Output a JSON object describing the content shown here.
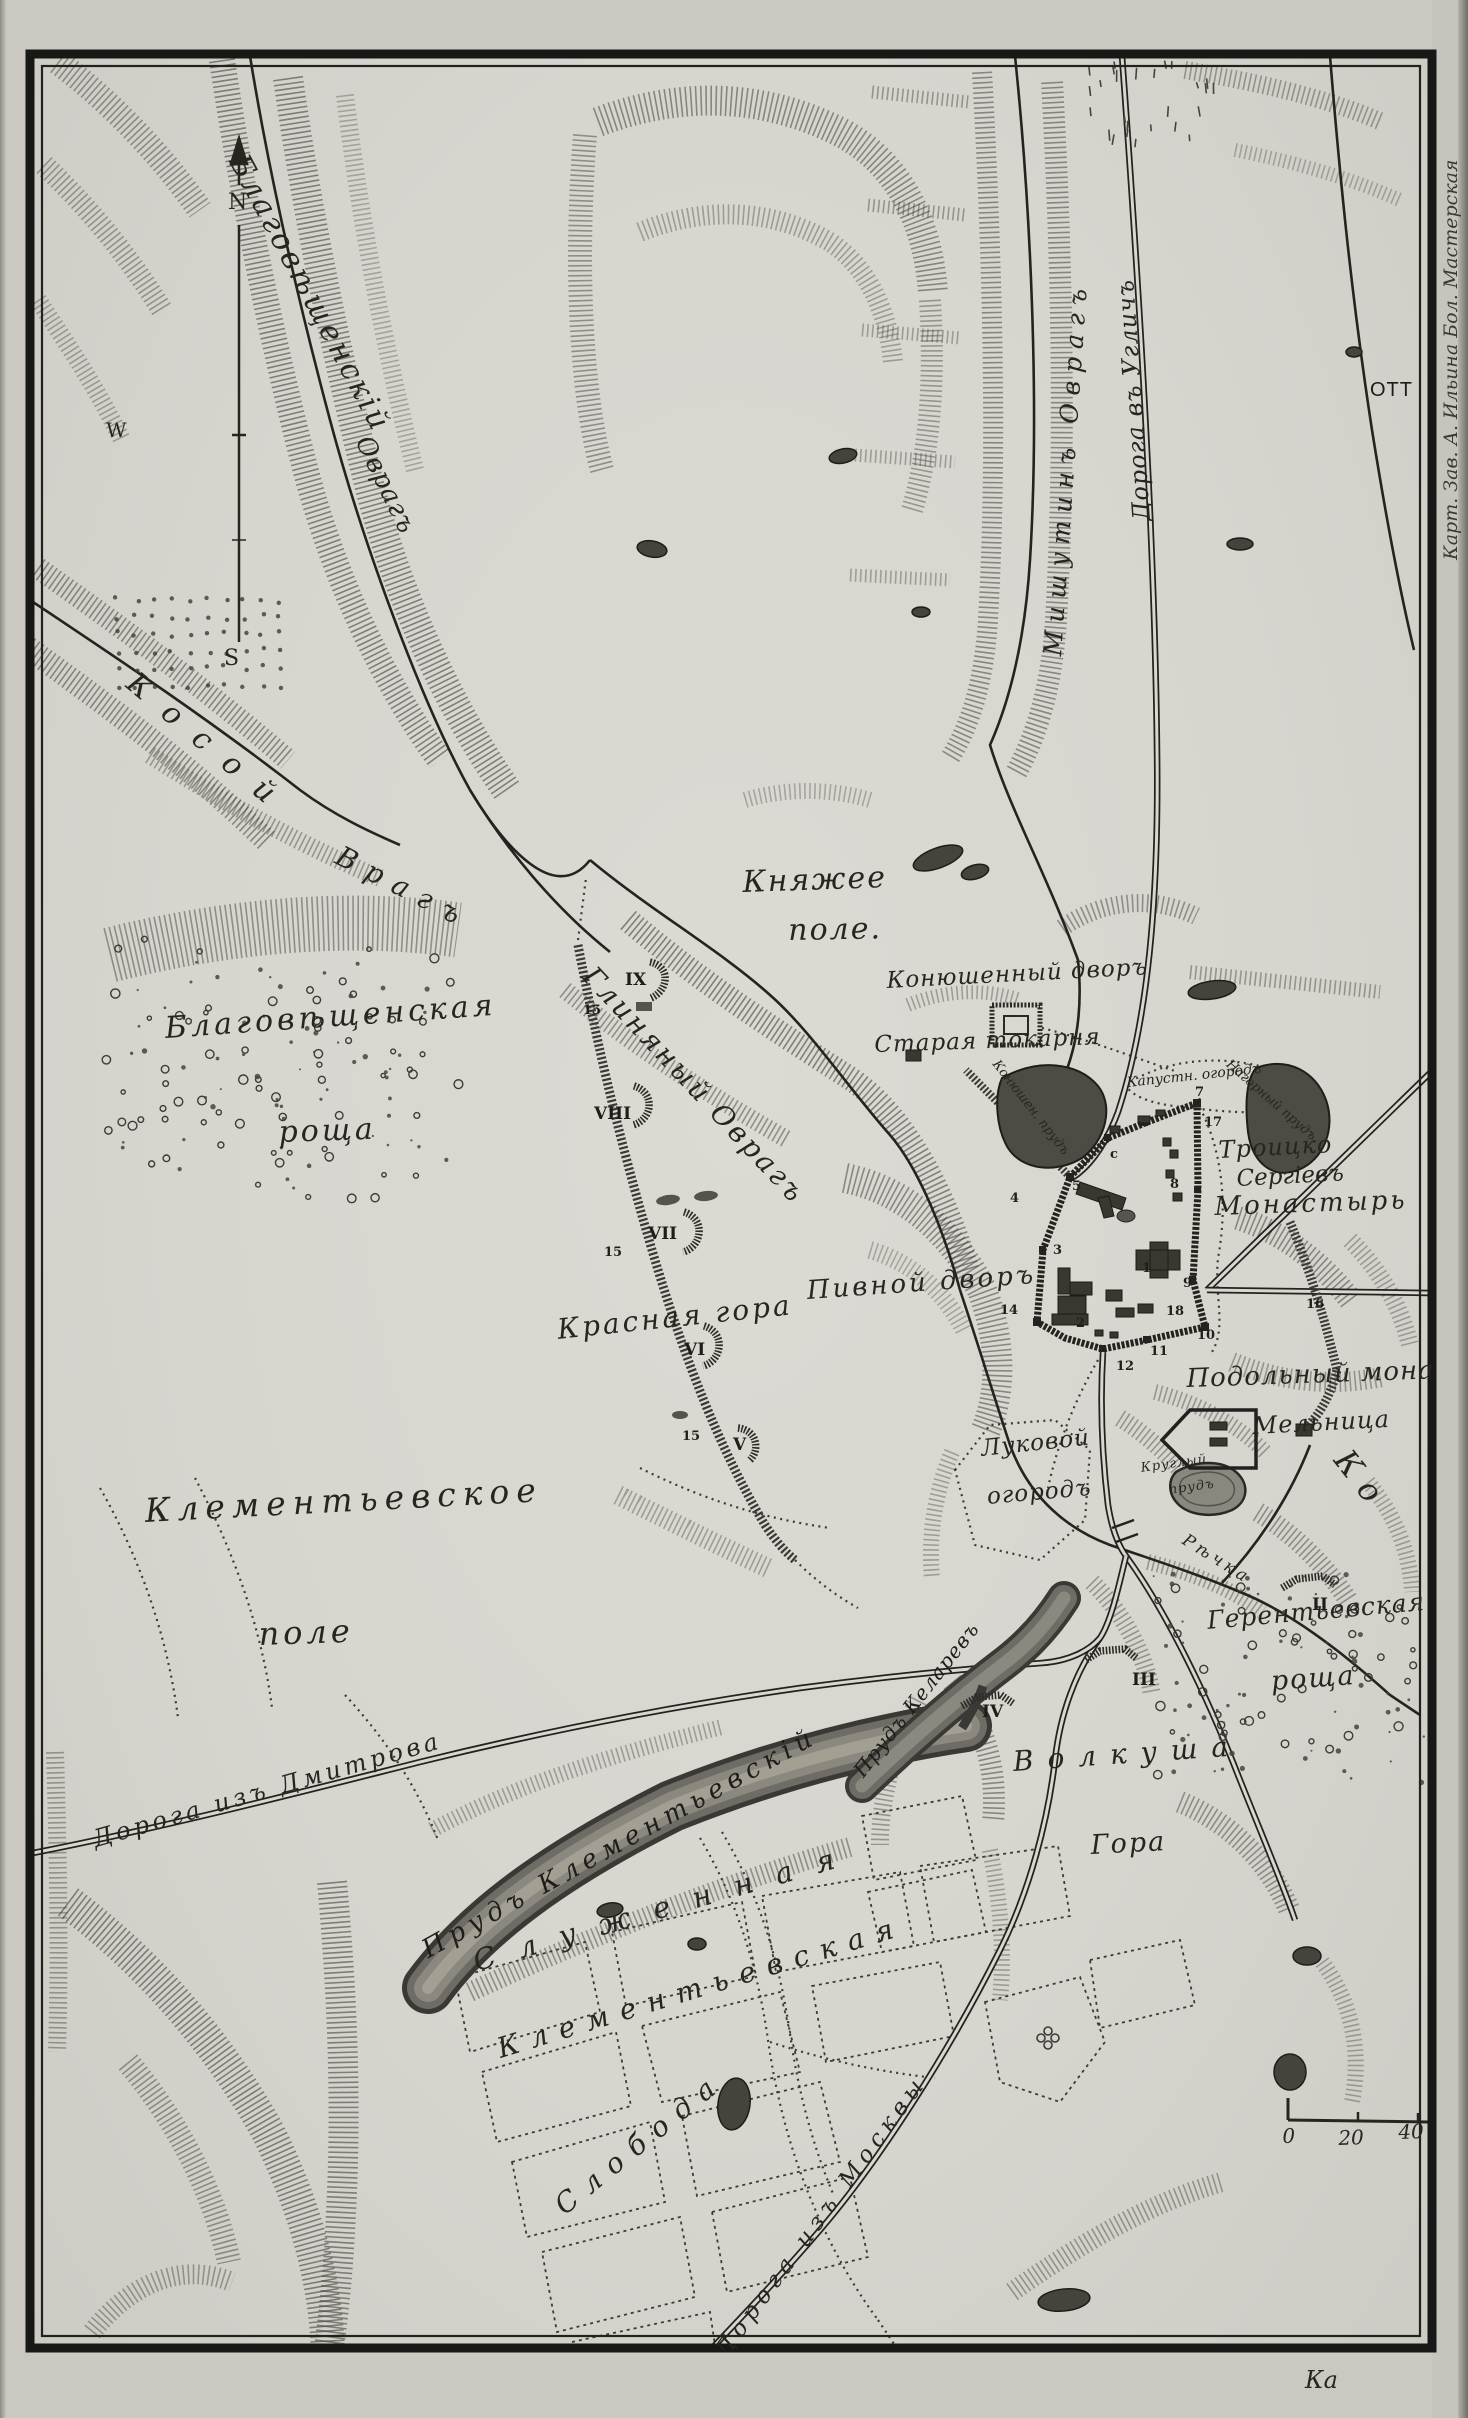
{
  "map": {
    "compass": {
      "n": "N",
      "w": "W",
      "s": "S"
    },
    "imprint": "Карт. Зав. А. Ильина Бол. Мастерская",
    "edge_fragment_right": "ОТТ",
    "edge_fragment_bottom": "Ка",
    "scale": {
      "t0": "0",
      "t20": "20",
      "t40": "40"
    },
    "labels": {
      "blagov_ovrag_1": "Благовѣщенскій",
      "blagov_ovrag_2": "Оврагъ",
      "kosoy_1": "Косой",
      "kosoy_2": "Врагъ",
      "roshcha_1": "Благовѣщенская",
      "roshcha_2": "роща",
      "knyazhee_1": "Княжее",
      "knyazhee_2": "поле.",
      "glinyany": "Глиняный Оврагъ",
      "mishutin": "Мишутинъ Оврагъ",
      "uglich": "Дорога въ Угличъ",
      "konyush_dvor": "Конюшенный дворъ",
      "tokarnya": "Старая токарня",
      "kapustn": "Капустн. огородъ",
      "nagorny": "Нагорный прудъ",
      "konyush_prud": "Конюшен. прудъ",
      "troitsko_1": "Троицко",
      "troitsko_2": "Сергіевъ",
      "troitsko_3": "Монастырь",
      "pivnoy": "Пивной дворъ",
      "krasnaya": "Красная гора",
      "podolny": "Подольный мона",
      "melnitsa": "Мельница",
      "krugly_1": "Круглый",
      "krugly_2": "прудъ",
      "lukovoy_1": "Луковой",
      "lukovoy_2": "огородъ",
      "klem_pole_1": "Клементьевское",
      "klem_pole_2": "поле",
      "gerent_1": "Герентьевская",
      "gerent_2": "роща",
      "prud_klem": "Прудъ Клементьевскій",
      "prud_kel": "Прудъ Келаревъ",
      "volkusha": "Волкуша",
      "gora": "Гора",
      "sluzhennaya": "Служенная",
      "klem_slob": "Клементьевская",
      "sloboda": "Слобода",
      "moskva_road": "Дорога изъ Москвы",
      "dmitrov_road": "Дорога изъ Дмитрова",
      "rechka": "Рѣчка",
      "konchura": "Ко"
    },
    "batteries": {
      "b2": "II",
      "b3": "III",
      "b4": "IV",
      "b5": "V",
      "b6": "VI",
      "b7": "VII",
      "b8": "VIII",
      "b9": "IX"
    },
    "numbers": {
      "n1": "1",
      "n2": "2",
      "n3": "3",
      "n4": "4",
      "n5": "5",
      "n7": "7",
      "n8": "8",
      "n9": "9",
      "n10": "10",
      "n11": "11",
      "n12": "12",
      "n14": "14",
      "n15": "15",
      "n16": "16",
      "n17": "17",
      "n18": "18",
      "nc": "c"
    }
  }
}
